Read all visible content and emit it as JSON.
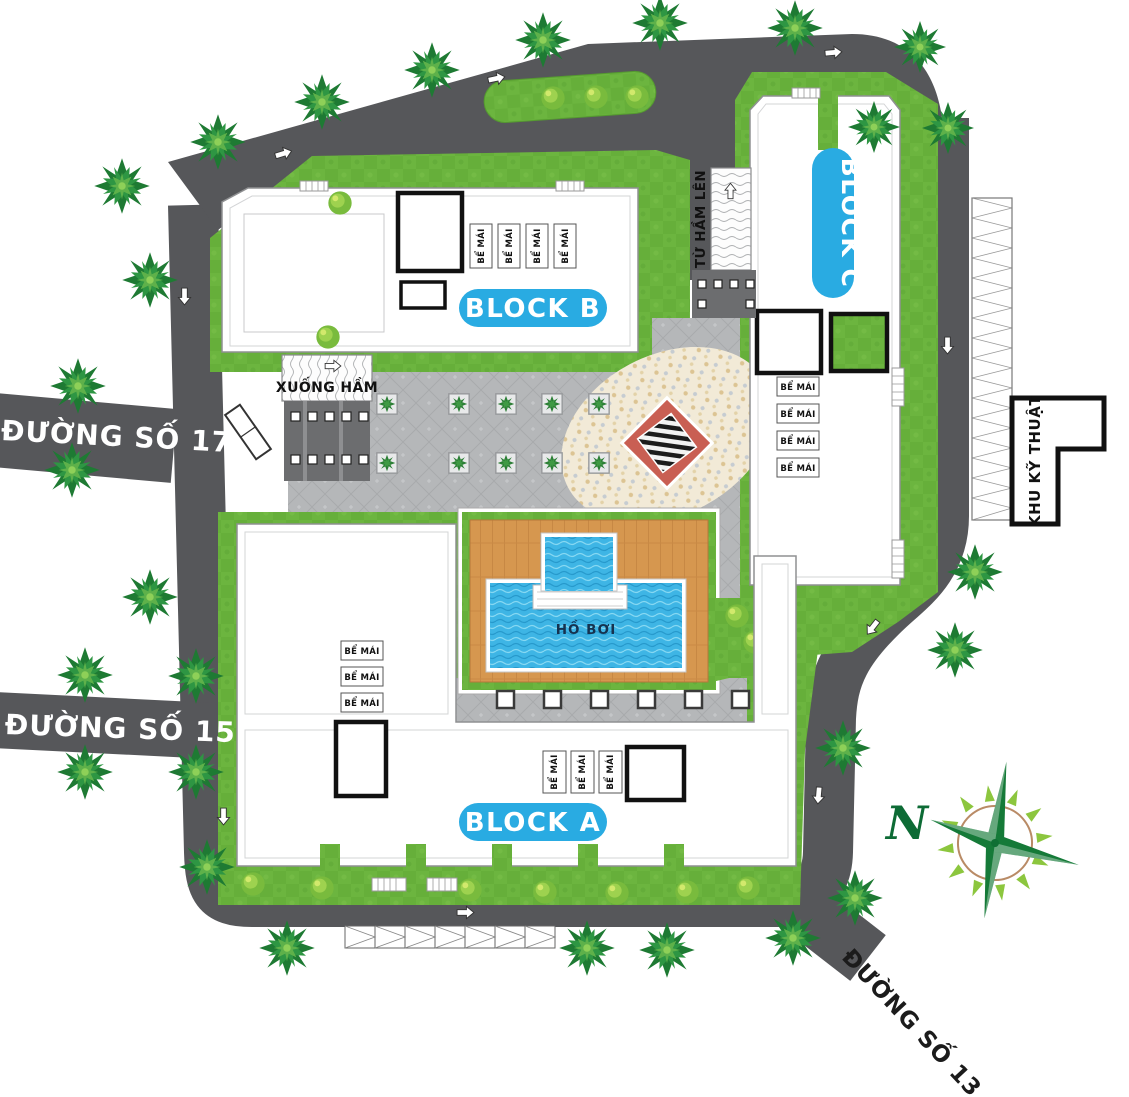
{
  "plan": {
    "blocks": {
      "a": {
        "label": "BLOCK A"
      },
      "b": {
        "label": "BLOCK B"
      },
      "c": {
        "label": "BLOCK C"
      }
    },
    "roads": {
      "r17": {
        "label": "ĐƯỜNG SỐ 17"
      },
      "r15": {
        "label": "ĐƯỜNG SỐ 15"
      },
      "r13": {
        "label": "ĐƯỜNG SỐ 13"
      }
    },
    "labels": {
      "ramp_down": "XUỐNG HẦM",
      "ramp_up": "TỪ HẦM LÊN",
      "tech_room": "KHU KỸ THUẬT",
      "pool": "HỒ BƠI",
      "roof_tank": "BỂ MÁI",
      "north": "N"
    },
    "colors": {
      "road": "#56575a",
      "grass": "#6cb53f",
      "water": "#3eb5e5",
      "deck_wood": "#d6974f",
      "accent_blue": "#29abe2",
      "diamond_red": "#c95f53",
      "plaza": "#b5b7b9",
      "mosaic": "#f2ead7",
      "compass_green": "#157a38"
    }
  }
}
